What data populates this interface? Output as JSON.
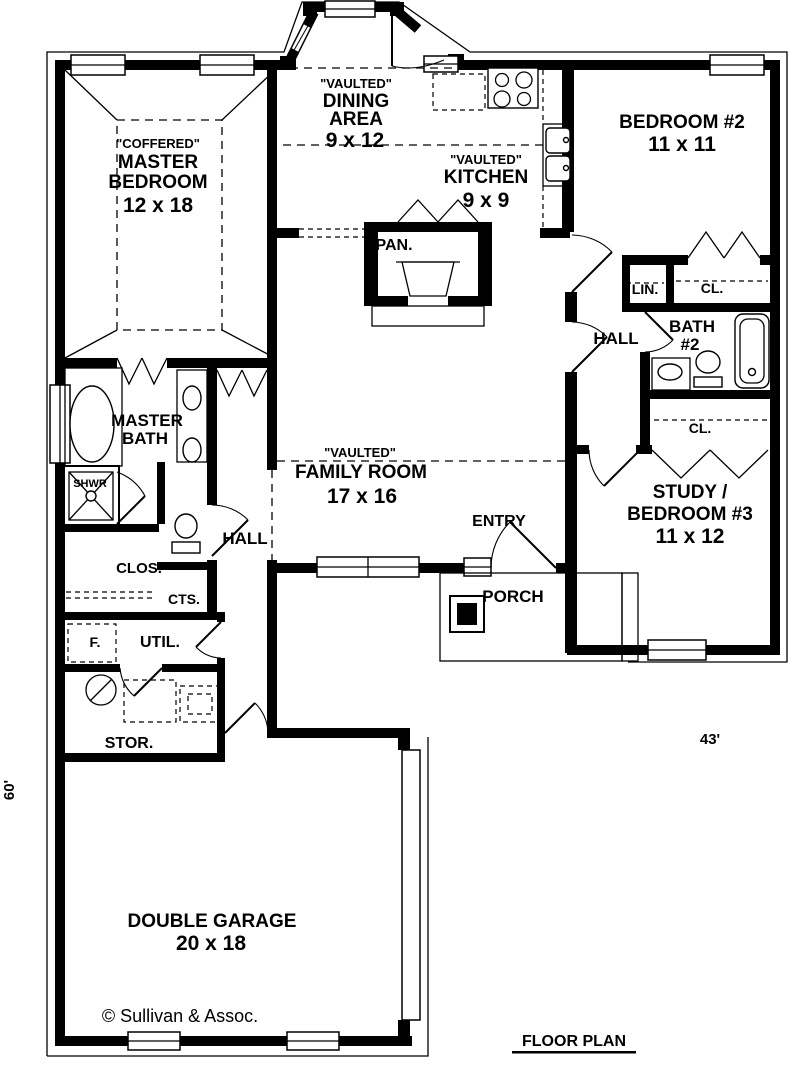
{
  "colors": {
    "ink": "#000000",
    "paper": "#ffffff"
  },
  "labels": {
    "master_bedroom": {
      "ceiling": "\"COFFERED\"",
      "name1": "MASTER",
      "name2": "BEDROOM",
      "size": "12 x 18"
    },
    "dining": {
      "ceiling": "\"VAULTED\"",
      "name1": "DINING",
      "name2": "AREA",
      "size": "9 x 12"
    },
    "kitchen": {
      "ceiling": "\"VAULTED\"",
      "name1": "KITCHEN",
      "size": "9 x 9"
    },
    "bedroom2": {
      "name": "BEDROOM #2",
      "size": "11 x 11"
    },
    "family_room": {
      "ceiling": "\"VAULTED\"",
      "name": "FAMILY ROOM",
      "size": "17 x 16"
    },
    "study": {
      "name1": "STUDY /",
      "name2": "BEDROOM #3",
      "size": "11 x 12"
    },
    "garage": {
      "name": "DOUBLE GARAGE",
      "size": "20 x 18"
    },
    "master_bath": {
      "name1": "MASTER",
      "name2": "BATH"
    },
    "bath2": {
      "name1": "BATH",
      "name2": "#2"
    },
    "hall_left": "HALL",
    "hall_right": "HALL",
    "entry": "ENTRY",
    "porch": "PORCH",
    "pantry": "PAN.",
    "linen": "LIN.",
    "bedroom2_closet": "CL.",
    "study_closet": "CL.",
    "master_closet": "CLOS.",
    "coat_closet": "CTS.",
    "utility": "UTIL.",
    "freezer": "F.",
    "storage": "STOR.",
    "shower": "SHWR"
  },
  "dimensions": {
    "width": "43'",
    "depth": "60'"
  },
  "footer": {
    "copyright": "© Sullivan & Assoc.",
    "title": "FLOOR PLAN"
  }
}
